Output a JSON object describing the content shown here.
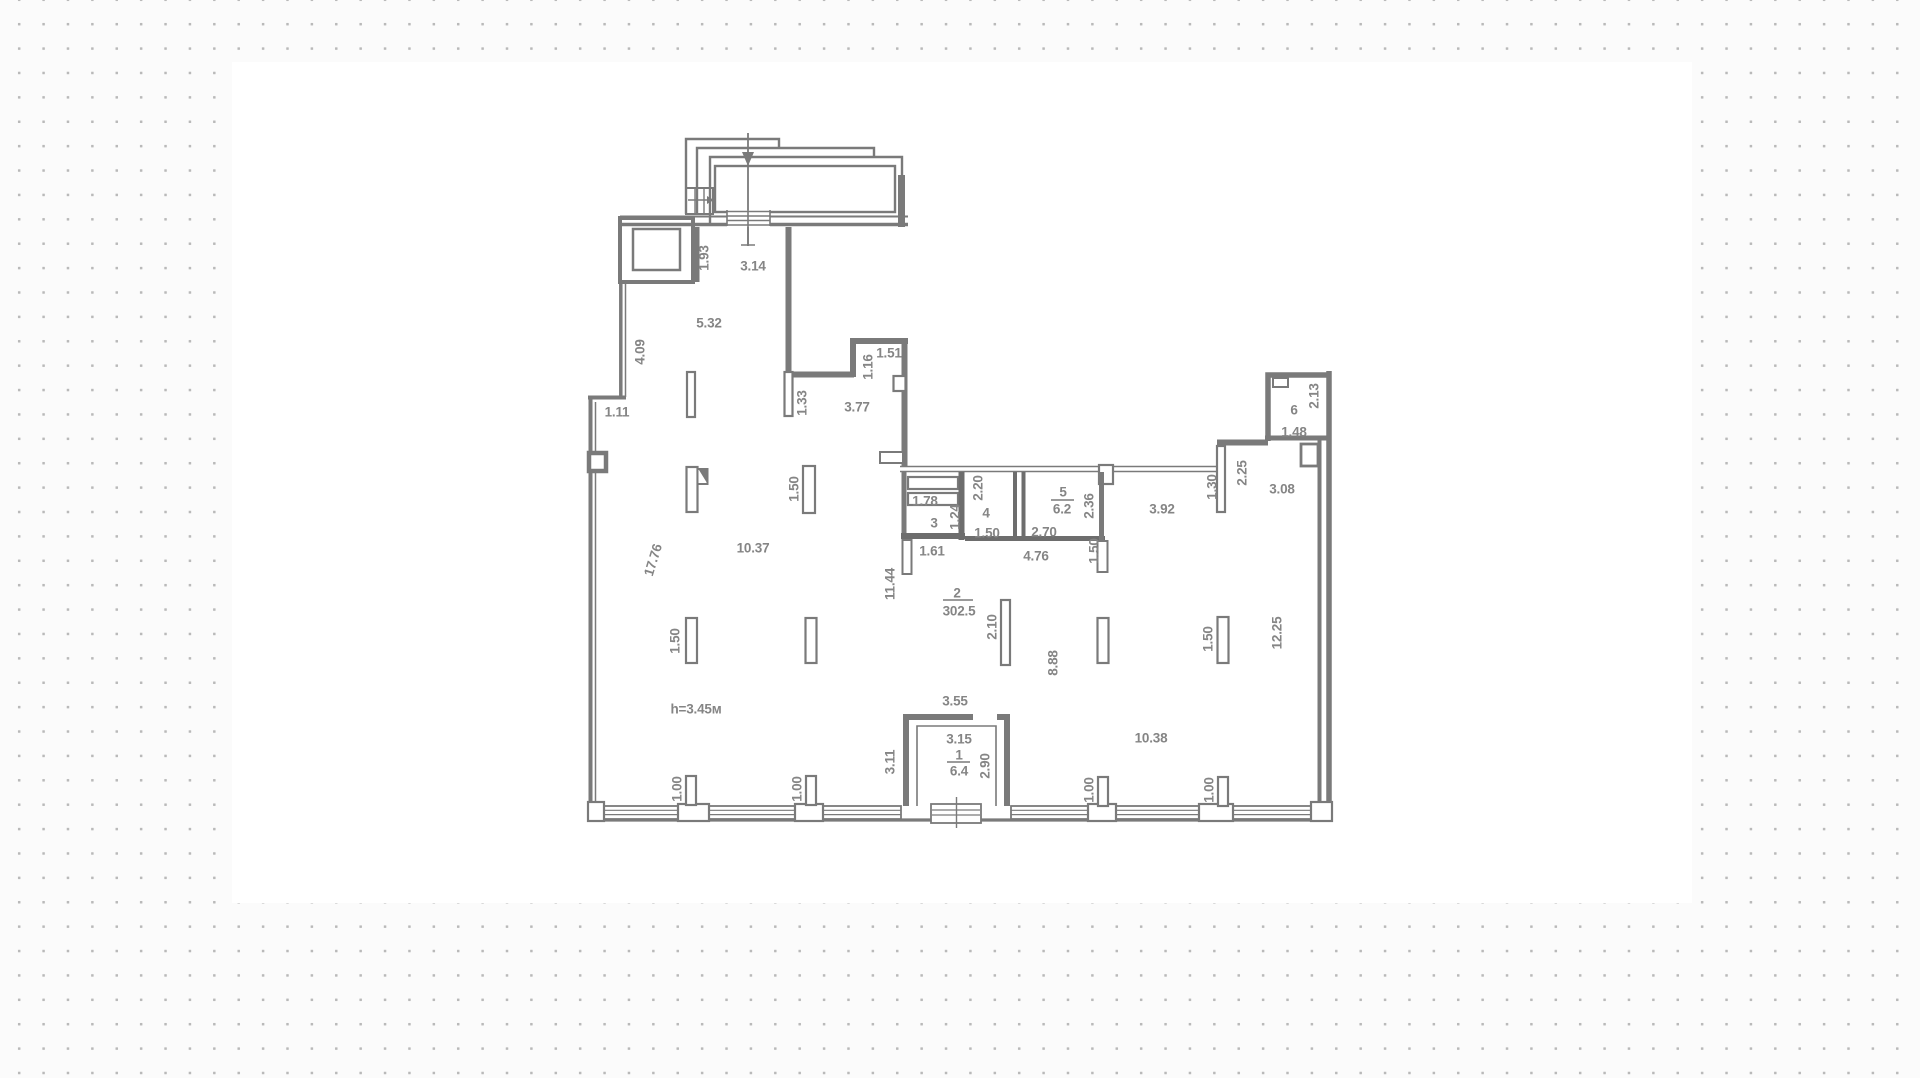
{
  "background": {
    "dot_color": "#b9b9b9",
    "page_color": "#fbfbfb",
    "panel_color": "#ffffff"
  },
  "plan": {
    "wall_color": "#7a7a7a",
    "label_color": "#858585",
    "rooms": [
      {
        "number": "1",
        "area": "6.4"
      },
      {
        "number": "2",
        "area": "302.5"
      },
      {
        "number": "3",
        "area": ""
      },
      {
        "number": "4",
        "area": ""
      },
      {
        "number": "5",
        "area": "6.2"
      },
      {
        "number": "6",
        "area": "1.48"
      }
    ],
    "labels": [
      {
        "text": "1.93",
        "x": 704,
        "y": 258,
        "rot": -90
      },
      {
        "text": "3.14",
        "x": 753,
        "y": 266
      },
      {
        "text": "5.32",
        "x": 709,
        "y": 323
      },
      {
        "text": "4.09",
        "x": 640,
        "y": 352,
        "rot": -90
      },
      {
        "text": "1.11",
        "x": 617,
        "y": 412
      },
      {
        "text": "1.51",
        "x": 889,
        "y": 353
      },
      {
        "text": "1.16",
        "x": 868,
        "y": 367,
        "rot": -90
      },
      {
        "text": "1.33",
        "x": 802,
        "y": 403,
        "rot": -90
      },
      {
        "text": "3.77",
        "x": 857,
        "y": 407
      },
      {
        "text": "17.76",
        "x": 653,
        "y": 560,
        "rot": -73
      },
      {
        "text": "10.37",
        "x": 753,
        "y": 548
      },
      {
        "text": "1.50",
        "x": 794,
        "y": 489,
        "rot": -90
      },
      {
        "text": "1.50",
        "x": 675,
        "y": 641,
        "rot": -90
      },
      {
        "text": "h=3.45м",
        "x": 696,
        "y": 709,
        "name": "height-label"
      },
      {
        "text": "11.44",
        "x": 890,
        "y": 584,
        "rot": -90
      },
      {
        "text": "2",
        "x": 957,
        "y": 593,
        "name": "room-number-label"
      },
      {
        "text": "302.5",
        "x": 959,
        "y": 611,
        "name": "room-area-label"
      },
      {
        "text": "1.61",
        "x": 932,
        "y": 551
      },
      {
        "text": "1.78",
        "x": 925,
        "y": 501
      },
      {
        "text": "1.24",
        "x": 955,
        "y": 517,
        "rot": -90
      },
      {
        "text": "3",
        "x": 934,
        "y": 523,
        "name": "room-number-label"
      },
      {
        "text": "2.20",
        "x": 978,
        "y": 488,
        "rot": -90
      },
      {
        "text": "4",
        "x": 986,
        "y": 513,
        "name": "room-number-label"
      },
      {
        "text": "1.50",
        "x": 987,
        "y": 533
      },
      {
        "text": "5",
        "x": 1063,
        "y": 492,
        "name": "room-number-label"
      },
      {
        "text": "6.2",
        "x": 1062,
        "y": 509,
        "name": "room-area-label"
      },
      {
        "text": "2.70",
        "x": 1044,
        "y": 532
      },
      {
        "text": "2.36",
        "x": 1089,
        "y": 506,
        "rot": -90
      },
      {
        "text": "4.76",
        "x": 1036,
        "y": 556
      },
      {
        "text": "1.50",
        "x": 1094,
        "y": 551,
        "rot": -90
      },
      {
        "text": "3.92",
        "x": 1162,
        "y": 509
      },
      {
        "text": "1.30",
        "x": 1212,
        "y": 487,
        "rot": -90
      },
      {
        "text": "2.25",
        "x": 1242,
        "y": 473,
        "rot": -90
      },
      {
        "text": "3.08",
        "x": 1282,
        "y": 489
      },
      {
        "text": "6",
        "x": 1294,
        "y": 410,
        "name": "room-number-label"
      },
      {
        "text": "1.48",
        "x": 1294,
        "y": 432,
        "name": "room-area-label"
      },
      {
        "text": "2.13",
        "x": 1314,
        "y": 396,
        "rot": -90
      },
      {
        "text": "2.10",
        "x": 992,
        "y": 627,
        "rot": -90
      },
      {
        "text": "8.88",
        "x": 1053,
        "y": 663,
        "rot": -90
      },
      {
        "text": "12.25",
        "x": 1277,
        "y": 633,
        "rot": -90
      },
      {
        "text": "1.50",
        "x": 1208,
        "y": 639,
        "rot": -90
      },
      {
        "text": "3.55",
        "x": 955,
        "y": 701
      },
      {
        "text": "3.15",
        "x": 959,
        "y": 739
      },
      {
        "text": "1",
        "x": 959,
        "y": 755,
        "name": "room-number-label"
      },
      {
        "text": "6.4",
        "x": 959,
        "y": 771,
        "name": "room-area-label"
      },
      {
        "text": "2.90",
        "x": 985,
        "y": 766,
        "rot": -90
      },
      {
        "text": "3.11",
        "x": 890,
        "y": 762,
        "rot": -90
      },
      {
        "text": "10.38",
        "x": 1151,
        "y": 738
      },
      {
        "text": "1.00",
        "x": 677,
        "y": 789,
        "rot": -90
      },
      {
        "text": "1.00",
        "x": 797,
        "y": 789,
        "rot": -90
      },
      {
        "text": "1.00",
        "x": 1089,
        "y": 790,
        "rot": -90
      },
      {
        "text": "1.00",
        "x": 1209,
        "y": 790,
        "rot": -90
      }
    ]
  }
}
